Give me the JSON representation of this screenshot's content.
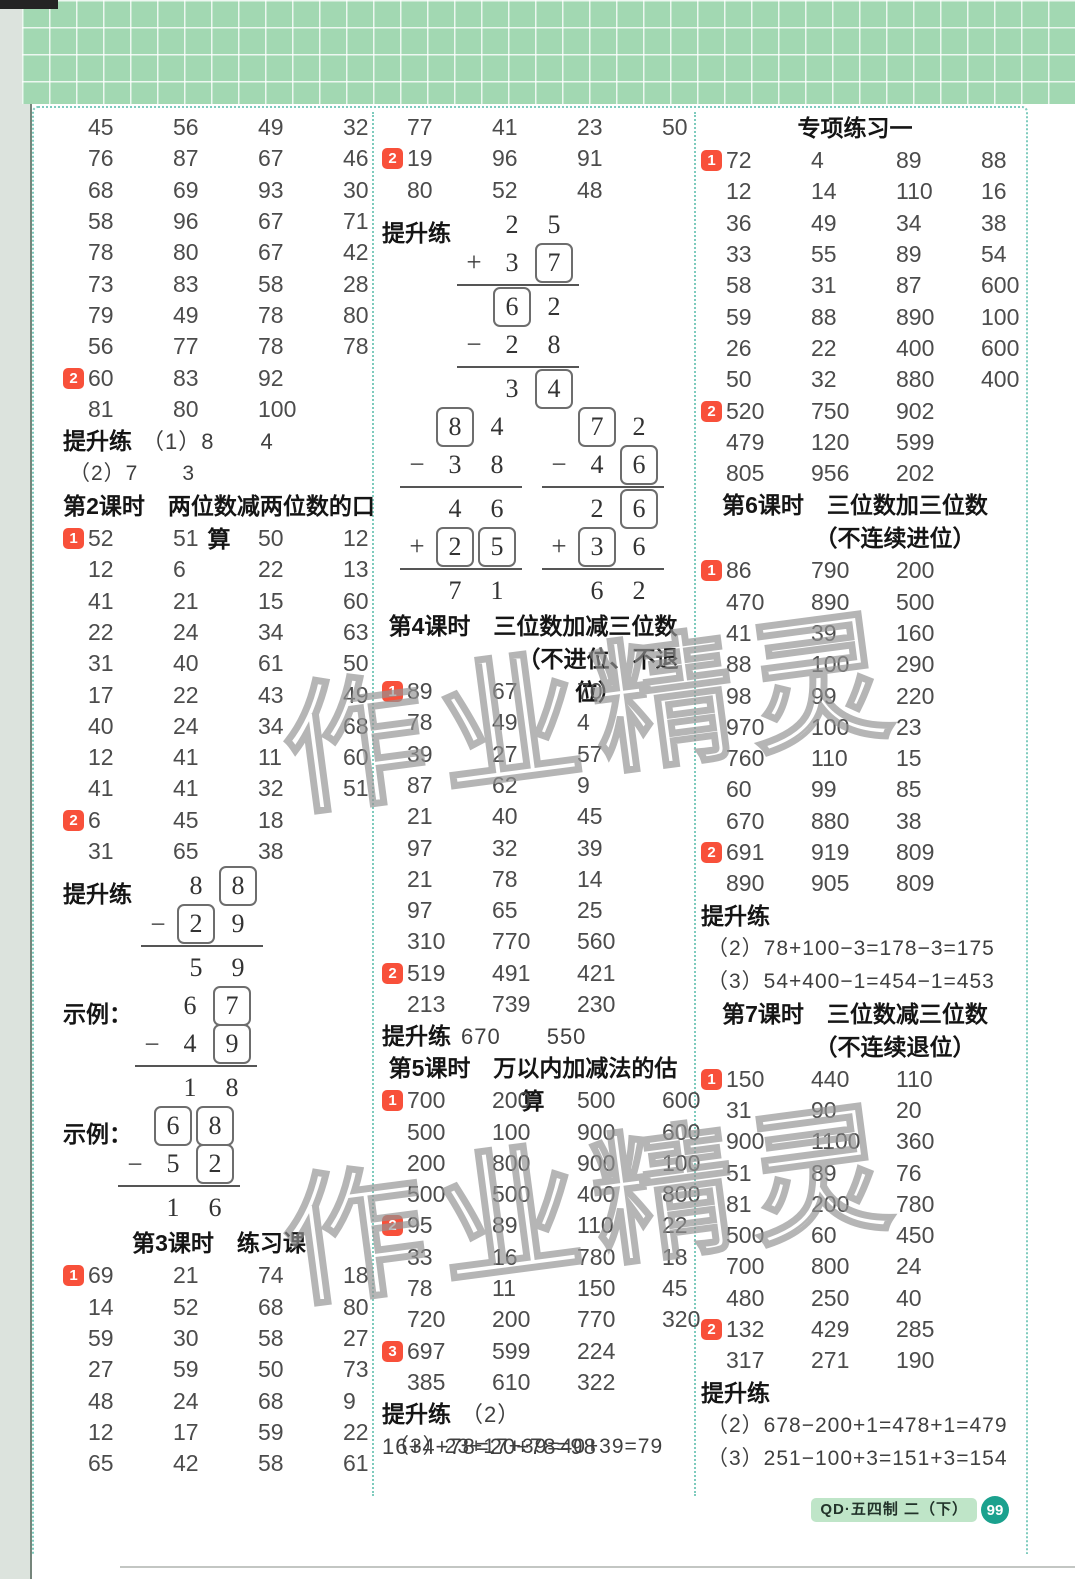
{
  "colors": {
    "badge_red": "#f8503a",
    "band_green": "#a2d8b2",
    "dotted_teal": "#7ecbbd",
    "page_circle_teal": "#1ba18e",
    "edition_highlight": "#bfe5c8"
  },
  "watermark": {
    "text": "作业精灵"
  },
  "footer": {
    "edition": "QD·五四制 二（下）",
    "page_number": "99"
  },
  "columns": [
    {
      "blocks": [
        {
          "type": "rows",
          "rows": [
            {
              "v": [
                "45",
                "56",
                "49",
                "32"
              ]
            },
            {
              "v": [
                "76",
                "87",
                "67",
                "46"
              ]
            },
            {
              "v": [
                "68",
                "69",
                "93",
                "30"
              ]
            },
            {
              "v": [
                "58",
                "96",
                "67",
                "71"
              ]
            },
            {
              "v": [
                "78",
                "80",
                "67",
                "42"
              ]
            },
            {
              "v": [
                "73",
                "83",
                "58",
                "28"
              ]
            },
            {
              "v": [
                "79",
                "49",
                "78",
                "80"
              ]
            },
            {
              "v": [
                "56",
                "77",
                "78",
                "78"
              ]
            },
            {
              "b": "2",
              "v": [
                "60",
                "83",
                "92"
              ]
            },
            {
              "v": [
                "81",
                "80",
                "100"
              ]
            }
          ]
        },
        {
          "type": "labelline",
          "label": "提升练",
          "text": "（1）8　　4"
        },
        {
          "type": "textline",
          "text": "（2）7　　3"
        },
        {
          "type": "header",
          "lines": [
            "第2课时　两位数减两位数的口算"
          ]
        },
        {
          "type": "rows",
          "rows": [
            {
              "b": "1",
              "v": [
                "52",
                "51",
                "50",
                "12"
              ]
            },
            {
              "v": [
                "12",
                "6",
                "22",
                "13"
              ]
            },
            {
              "v": [
                "41",
                "21",
                "15",
                "60"
              ]
            },
            {
              "v": [
                "22",
                "24",
                "34",
                "63"
              ]
            },
            {
              "v": [
                "31",
                "40",
                "61",
                "50"
              ]
            },
            {
              "v": [
                "17",
                "22",
                "43",
                "49"
              ]
            },
            {
              "v": [
                "40",
                "24",
                "34",
                "68"
              ]
            },
            {
              "v": [
                "12",
                "41",
                "11",
                "60"
              ]
            },
            {
              "v": [
                "41",
                "41",
                "32",
                "51"
              ]
            },
            {
              "b": "2",
              "v": [
                "6",
                "45",
                "18"
              ]
            },
            {
              "v": [
                "31",
                "65",
                "38"
              ]
            }
          ]
        },
        {
          "type": "vertical",
          "label": "提升练",
          "ml": 78,
          "rows": [
            {
              "s": "",
              "d": [
                "8",
                "[8]"
              ]
            },
            {
              "s": "−",
              "d": [
                "[2]",
                "9"
              ]
            },
            "rule",
            {
              "s": "",
              "d": [
                "5",
                "9"
              ]
            }
          ]
        },
        {
          "type": "vertical",
          "label": "示例：",
          "ml": 72,
          "rows": [
            {
              "s": "",
              "d": [
                "6",
                "[7]"
              ]
            },
            {
              "s": "−",
              "d": [
                "4",
                "[9]"
              ]
            },
            "rule",
            {
              "s": "",
              "d": [
                "1",
                "8"
              ]
            }
          ]
        },
        {
          "type": "vertical",
          "label": "示例：",
          "ml": 55,
          "rows": [
            {
              "s": "",
              "d": [
                "[6]",
                "[8]"
              ]
            },
            {
              "s": "−",
              "d": [
                "5",
                "[2]"
              ]
            },
            "rule",
            {
              "s": "",
              "d": [
                "1",
                "6"
              ]
            }
          ]
        },
        {
          "type": "header",
          "lines": [
            "第3课时　练习课"
          ]
        },
        {
          "type": "rows",
          "rows": [
            {
              "b": "1",
              "v": [
                "69",
                "21",
                "74",
                "18"
              ]
            },
            {
              "v": [
                "14",
                "52",
                "68",
                "80"
              ]
            },
            {
              "v": [
                "59",
                "30",
                "58",
                "27"
              ]
            },
            {
              "v": [
                "27",
                "59",
                "50",
                "73"
              ]
            },
            {
              "v": [
                "48",
                "24",
                "68",
                "9"
              ]
            },
            {
              "v": [
                "12",
                "17",
                "59",
                "22"
              ]
            },
            {
              "v": [
                "65",
                "42",
                "58",
                "61"
              ]
            }
          ]
        }
      ]
    },
    {
      "blocks": [
        {
          "type": "rows",
          "rows": [
            {
              "v": [
                "77",
                "41",
                "23",
                "50"
              ]
            },
            {
              "b": "2",
              "v": [
                "19",
                "96",
                "91"
              ]
            },
            {
              "v": [
                "80",
                "52",
                "48"
              ]
            }
          ]
        },
        {
          "type": "vertical",
          "label": "提升练",
          "ml": 75,
          "rows": [
            {
              "s": "",
              "d": [
                "2",
                "5"
              ]
            },
            {
              "s": "+",
              "d": [
                "3",
                "[7]"
              ]
            },
            "rule",
            {
              "s": "",
              "d": [
                "[6]",
                "2"
              ]
            },
            {
              "s": "−",
              "d": [
                "2",
                "8"
              ]
            },
            "rule",
            {
              "s": "",
              "d": [
                "3",
                "[4]"
              ]
            }
          ]
        },
        {
          "type": "vpair",
          "left": {
            "ml": 18,
            "rows": [
              {
                "s": "",
                "d": [
                  "[8]",
                  "4"
                ]
              },
              {
                "s": "−",
                "d": [
                  "3",
                  "8"
                ]
              },
              "rule",
              {
                "s": "",
                "d": [
                  "4",
                  "6"
                ]
              },
              {
                "s": "+",
                "d": [
                  "[2]",
                  "[5]"
                ]
              },
              "rule",
              {
                "s": "",
                "d": [
                  "7",
                  "1"
                ]
              }
            ]
          },
          "right": {
            "ml": 160,
            "rows": [
              {
                "s": "",
                "d": [
                  "[7]",
                  "2"
                ]
              },
              {
                "s": "−",
                "d": [
                  "4",
                  "[6]"
                ]
              },
              "rule",
              {
                "s": "",
                "d": [
                  "2",
                  "[6]"
                ]
              },
              {
                "s": "+",
                "d": [
                  "[3]",
                  "6"
                ]
              },
              "rule",
              {
                "s": "",
                "d": [
                  "6",
                  "2"
                ]
              }
            ]
          }
        },
        {
          "type": "header",
          "lines": [
            "第4课时　三位数加减三位数",
            "（不进位、不退位）"
          ]
        },
        {
          "type": "rows",
          "rows": [
            {
              "b": "1",
              "v": [
                "89",
                "67",
                "70"
              ]
            },
            {
              "v": [
                "78",
                "49",
                "4"
              ]
            },
            {
              "v": [
                "39",
                "27",
                "57"
              ]
            },
            {
              "v": [
                "87",
                "62",
                "9"
              ]
            },
            {
              "v": [
                "21",
                "40",
                "45"
              ]
            },
            {
              "v": [
                "97",
                "32",
                "39"
              ]
            },
            {
              "v": [
                "21",
                "78",
                "14"
              ]
            },
            {
              "v": [
                "97",
                "65",
                "25"
              ]
            },
            {
              "v": [
                "310",
                "770",
                "560"
              ]
            },
            {
              "b": "2",
              "v": [
                "519",
                "491",
                "421"
              ]
            },
            {
              "v": [
                "213",
                "739",
                "230"
              ]
            }
          ]
        },
        {
          "type": "labelline",
          "label": "提升练",
          "text": "670　　550"
        },
        {
          "type": "header",
          "lines": [
            "第5课时　万以内加减法的估算"
          ]
        },
        {
          "type": "rows",
          "rows": [
            {
              "b": "1",
              "v": [
                "700",
                "200",
                "500",
                "600"
              ]
            },
            {
              "v": [
                "500",
                "100",
                "900",
                "600"
              ]
            },
            {
              "v": [
                "200",
                "800",
                "900",
                "100"
              ]
            },
            {
              "v": [
                "500",
                "500",
                "400",
                "800"
              ]
            },
            {
              "b": "2",
              "v": [
                "95",
                "89",
                "110",
                "22"
              ]
            },
            {
              "v": [
                "33",
                "16",
                "780",
                "18"
              ]
            },
            {
              "v": [
                "78",
                "11",
                "150",
                "45"
              ]
            },
            {
              "v": [
                "720",
                "200",
                "770",
                "320"
              ]
            },
            {
              "b": "3",
              "v": [
                "697",
                "599",
                "224"
              ]
            },
            {
              "v": [
                "385",
                "610",
                "322"
              ]
            }
          ]
        },
        {
          "type": "labelline",
          "label": "提升练",
          "text": "（2）16+4+78=20+78=98"
        },
        {
          "type": "textline",
          "text": "（3）23+17+39=40+39=79"
        }
      ]
    },
    {
      "blocks": [
        {
          "type": "header",
          "lines": [
            "专项练习一"
          ]
        },
        {
          "type": "rows",
          "rows": [
            {
              "b": "1",
              "v": [
                "72",
                "4",
                "89",
                "88"
              ]
            },
            {
              "v": [
                "12",
                "14",
                "110",
                "16"
              ]
            },
            {
              "v": [
                "36",
                "49",
                "34",
                "38"
              ]
            },
            {
              "v": [
                "33",
                "55",
                "89",
                "54"
              ]
            },
            {
              "v": [
                "58",
                "31",
                "87",
                "600"
              ]
            },
            {
              "v": [
                "59",
                "88",
                "890",
                "100"
              ]
            },
            {
              "v": [
                "26",
                "22",
                "400",
                "600"
              ]
            },
            {
              "v": [
                "50",
                "32",
                "880",
                "400"
              ]
            },
            {
              "b": "2",
              "v": [
                "520",
                "750",
                "902"
              ]
            },
            {
              "v": [
                "479",
                "120",
                "599"
              ]
            },
            {
              "v": [
                "805",
                "956",
                "202"
              ]
            }
          ]
        },
        {
          "type": "header",
          "lines": [
            "第6课时　三位数加三位数",
            "（不连续进位）"
          ]
        },
        {
          "type": "rows",
          "rows": [
            {
              "b": "1",
              "v": [
                "86",
                "790",
                "200"
              ]
            },
            {
              "v": [
                "470",
                "890",
                "500"
              ]
            },
            {
              "v": [
                "41",
                "39",
                "160"
              ]
            },
            {
              "v": [
                "88",
                "100",
                "290"
              ]
            },
            {
              "v": [
                "98",
                "99",
                "220"
              ]
            },
            {
              "v": [
                "970",
                "100",
                "23"
              ]
            },
            {
              "v": [
                "760",
                "110",
                "15"
              ]
            },
            {
              "v": [
                "60",
                "99",
                "85"
              ]
            },
            {
              "v": [
                "670",
                "880",
                "38"
              ]
            },
            {
              "b": "2",
              "v": [
                "691",
                "919",
                "809"
              ]
            },
            {
              "v": [
                "890",
                "905",
                "809"
              ]
            }
          ]
        },
        {
          "type": "labelline",
          "label": "提升练",
          "text": ""
        },
        {
          "type": "textline",
          "text": "（2）78+100−3=178−3=175"
        },
        {
          "type": "textline",
          "text": "（3）54+400−1=454−1=453"
        },
        {
          "type": "header",
          "lines": [
            "第7课时　三位数减三位数",
            "（不连续退位）"
          ]
        },
        {
          "type": "rows",
          "rows": [
            {
              "b": "1",
              "v": [
                "150",
                "440",
                "110"
              ]
            },
            {
              "v": [
                "31",
                "90",
                "20"
              ]
            },
            {
              "v": [
                "900",
                "1100",
                "360"
              ]
            },
            {
              "v": [
                "51",
                "89",
                "76"
              ]
            },
            {
              "v": [
                "81",
                "200",
                "780"
              ]
            },
            {
              "v": [
                "500",
                "60",
                "450"
              ]
            },
            {
              "v": [
                "700",
                "800",
                "24"
              ]
            },
            {
              "v": [
                "480",
                "250",
                "40"
              ]
            },
            {
              "b": "2",
              "v": [
                "132",
                "429",
                "285"
              ]
            },
            {
              "v": [
                "317",
                "271",
                "190"
              ]
            }
          ]
        },
        {
          "type": "labelline",
          "label": "提升练",
          "text": ""
        },
        {
          "type": "textline",
          "text": "（2）678−200+1=478+1=479"
        },
        {
          "type": "textline",
          "text": "（3）251−100+3=151+3=154"
        }
      ]
    }
  ]
}
